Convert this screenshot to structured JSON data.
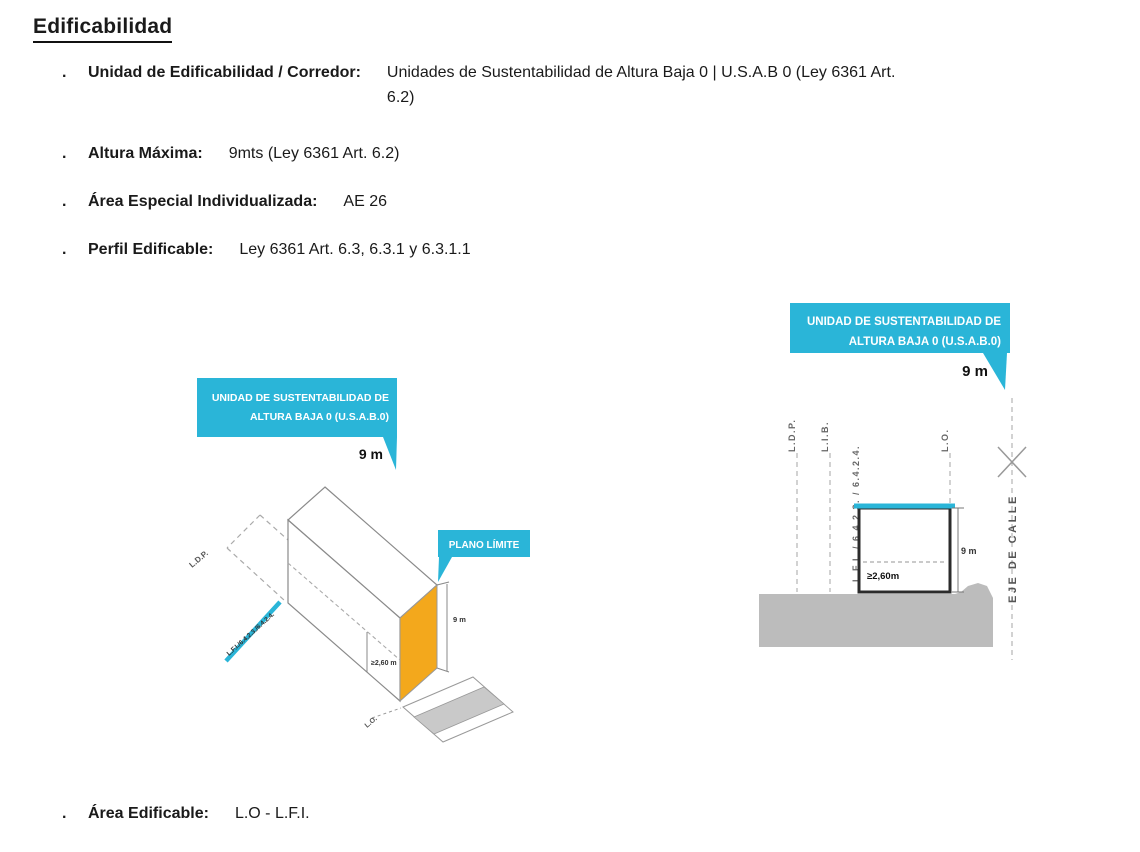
{
  "title": "Edificabilidad",
  "bullet_char": ".",
  "bullets": [
    {
      "label": "Unidad de Edificabilidad / Corredor:",
      "value": "Unidades de Sustentabilidad de Altura Baja 0 | U.S.A.B 0 (Ley 6361 Art.",
      "value_line2": "6.2)"
    },
    {
      "label": "Altura Máxima:",
      "value": "9mts (Ley 6361 Art. 6.2)"
    },
    {
      "label": "Área Especial Individualizada:",
      "value": "AE 26"
    },
    {
      "label": "Perfil Edificable:",
      "value": "Ley 6361 Art. 6.3, 6.3.1 y 6.3.1.1"
    },
    {
      "label": "Área Edificable:",
      "value": "L.O - L.F.I."
    }
  ],
  "colors": {
    "cyan": "#2ab5d8",
    "orange": "#f3a81c",
    "ground_gray": "#bcbcbc",
    "street_gray": "#c9c9c9"
  },
  "iso_diagram": {
    "callout_line1": "UNIDAD DE SUSTENTABILIDAD DE",
    "callout_line2": "ALTURA BAJA 0 (U.S.A.B.0)",
    "callout_height": "9 m",
    "plano_limite": "PLANO LÍMITE",
    "ldp": "L.D.P.",
    "lfi": "L.F.I./6.4.2.3./6.4.2.4.",
    "min_height": "≥2,60 m",
    "height_dim": "9 m",
    "lo": "L.O."
  },
  "section_diagram": {
    "callout_line1": "UNIDAD DE SUSTENTABILIDAD DE",
    "callout_line2": "ALTURA BAJA 0 (U.S.A.B.0)",
    "callout_height": "9 m",
    "ldp": "L.D.P.",
    "lib": "L.I.B.",
    "lfi": "L.F.I. / 6.4.2.3. / 6.4.2.4.",
    "lo": "L.O.",
    "min_height": "≥2,60m",
    "height_dim": "9 m",
    "eje": "EJE DE CALLE"
  }
}
